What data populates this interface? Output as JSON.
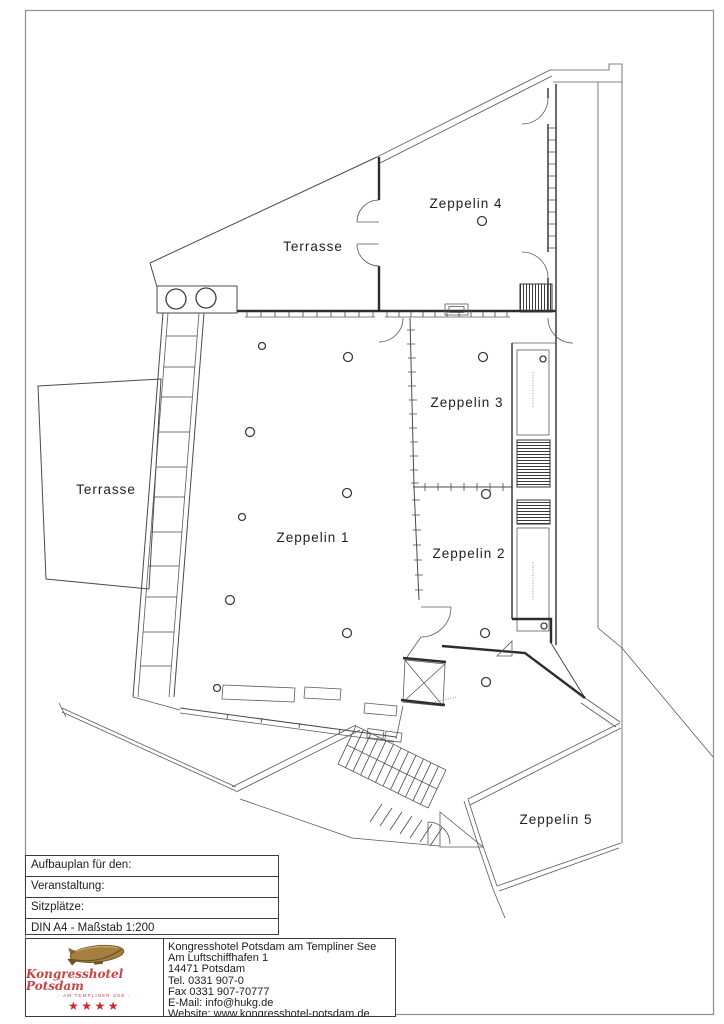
{
  "page": {
    "type": "floor-plan-document"
  },
  "plan": {
    "rooms": [
      {
        "id": "zeppelin-4",
        "label": "Zeppelin 4"
      },
      {
        "id": "terrasse-upper",
        "label": "Terrasse"
      },
      {
        "id": "zeppelin-3",
        "label": "Zeppelin 3"
      },
      {
        "id": "terrasse-left",
        "label": "Terrasse"
      },
      {
        "id": "zeppelin-1",
        "label": "Zeppelin 1"
      },
      {
        "id": "zeppelin-2",
        "label": "Zeppelin 2"
      },
      {
        "id": "zeppelin-5",
        "label": "Zeppelin 5"
      }
    ]
  },
  "title_block": {
    "rows": [
      "Aufbauplan für den:",
      "Veranstaltung:",
      "Sitzplätze:",
      "DIN A4 - Maßstab 1:200"
    ]
  },
  "vendor": {
    "name": "Kongresshotel Potsdam",
    "subtitle": "- AM TEMPLINER SEE -",
    "stars": "★★★★",
    "contact_lines": [
      "Kongresshotel Potsdam am Templiner See",
      "Am Luftschiffhafen 1",
      "14471 Potsdam",
      "Tel. 0331 907-0",
      "Fax 0331 907-70777",
      "E-Mail: info@hukg.de",
      "Website: www.kongresshotel-potsdam.de"
    ]
  },
  "colors": {
    "line": "#4a4a4a",
    "logo_red": "#cb4245",
    "star_red": "#cf2630",
    "zeppelin_gold": "#a3803f"
  }
}
